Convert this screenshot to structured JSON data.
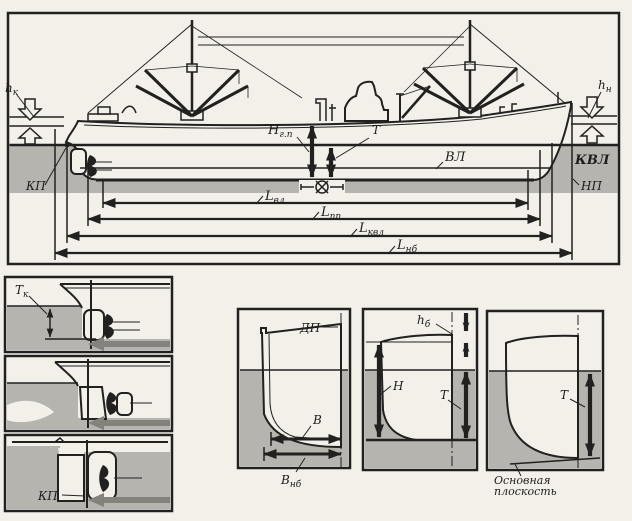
{
  "colors": {
    "paper": "#f2f0e9",
    "ink": "#222120",
    "water": "#b5b4af",
    "gray_arrow": "#83827d"
  },
  "main": {
    "h_k": {
      "main": "h",
      "sub": "к"
    },
    "h_n": {
      "main": "h",
      "sub": "н"
    },
    "H_gp": {
      "main": "Н",
      "sub": "г.п"
    },
    "T": "Т",
    "VL": "ВЛ",
    "KVL": "КВЛ",
    "KP": "КП",
    "NP": "НП",
    "L_vl": {
      "main": "L",
      "sub": "вл"
    },
    "L_pp": {
      "main": "L",
      "sub": "пп"
    },
    "L_kvl": {
      "main": "L",
      "sub": "квл"
    },
    "L_nb": {
      "main": "L",
      "sub": "нб"
    }
  },
  "stern_panels": {
    "T_k": {
      "main": "Т",
      "sub": "к"
    },
    "KP": "КП"
  },
  "sections": {
    "DP": "ДП",
    "B": "В",
    "B_nb": {
      "main": "В",
      "sub": "нб"
    },
    "h_b": {
      "main": "h",
      "sub": "б"
    },
    "H": "Н",
    "T_mid": "Т",
    "T_right": "Т",
    "base_plane_1": "Основная",
    "base_plane_2": "плоскость"
  }
}
